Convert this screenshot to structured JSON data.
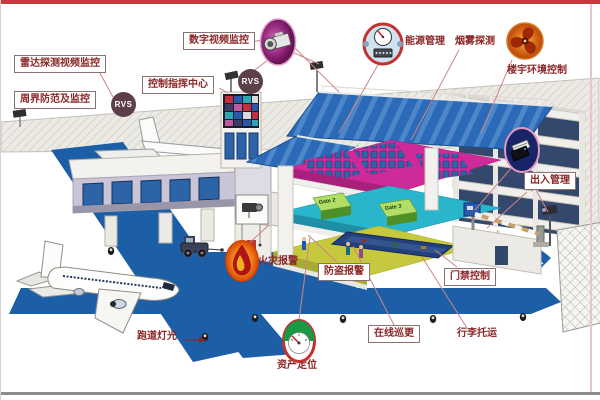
{
  "labels": {
    "radar_video": "雷达探测视频监控",
    "perimeter": "周界防范及监控",
    "digital_video": "数字视频监控",
    "control_center": "控制指挥中心",
    "energy": "能源管理",
    "smoke": "烟雾探测",
    "building_env": "楼宇环境控制",
    "access_mgmt": "出入管理",
    "fire_alarm": "火灾报警",
    "burglar_alarm": "防盗报警",
    "door_access": "门禁控制",
    "online_patrol": "在线巡更",
    "baggage": "行李托运",
    "runway_light": "跑道灯光",
    "asset_location": "资产定位"
  },
  "badges": {
    "rvs": "RVS"
  },
  "building": {
    "gates": [
      "Gate 2",
      "Gate 3"
    ]
  },
  "icons": {
    "camera": "surveillance-camera-icon",
    "meter": "energy-meter-icon",
    "fan": "ventilation-fan-icon",
    "access_card": "access-card-reader-icon",
    "flame": "fire-flame-icon",
    "gauge": "asset-gauge-icon"
  },
  "colors": {
    "label_text": "#8b2626",
    "label_border": "#8a7272",
    "connector": "#d08484",
    "runway_blue": "#1d5fa6",
    "roof_blue": "#2a6ab8",
    "floor_pink": "#cf2a9a",
    "floor_cyan": "#29b5cc",
    "floor_yellow": "#c6c93e",
    "counter_green": "#8ec84e",
    "rvs_bg": "#5d3f4a",
    "frame_top": "#c23a3a",
    "frame_bottom": "#8c8c8c"
  }
}
